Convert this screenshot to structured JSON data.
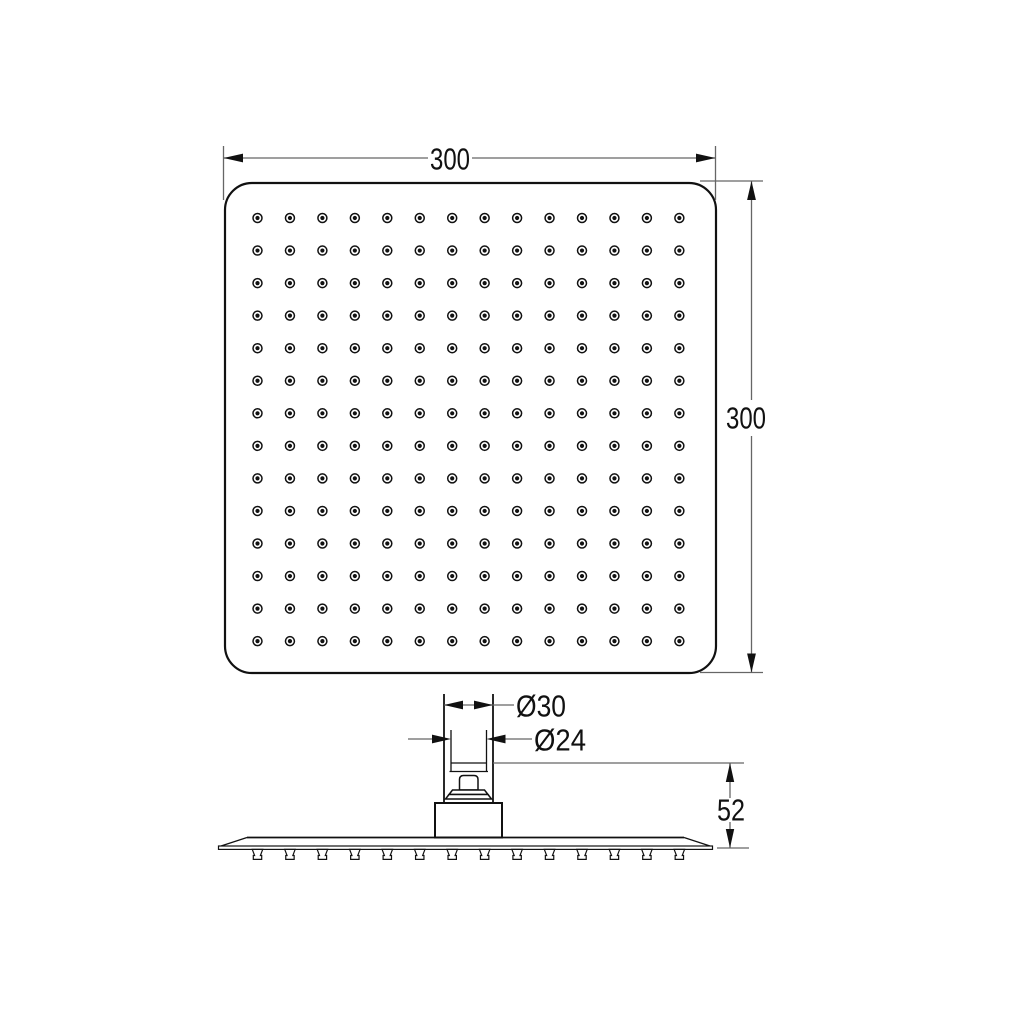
{
  "dimensions": {
    "width": "300",
    "height": "300",
    "outer_diameter": "Ø30",
    "inner_diameter": "Ø24",
    "mounting_height": "52"
  },
  "face_view": {
    "nozzle_rows": 14,
    "nozzle_cols": 14
  },
  "side_view": {
    "nozzle_count": 14
  },
  "colors": {
    "object_line": "#111111",
    "dimension_line": "#666666",
    "text": "#111111",
    "background": "#ffffff"
  }
}
